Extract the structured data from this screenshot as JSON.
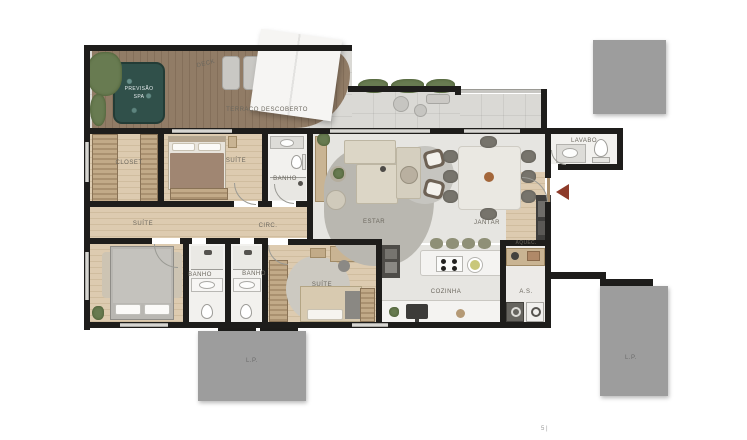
{
  "floorplan": {
    "labels": {
      "deck": "DECK",
      "terrace": "TERRAÇO DESCOBERTO",
      "spa_line1": "PREVISÃO",
      "spa_line2": "SPA",
      "closet": "CLOSET",
      "suite_master": "SUÍTE",
      "banho_master": "BANHO",
      "suite_hall": "SUÍTE",
      "circ": "CIRC.",
      "estar": "ESTAR",
      "jantar": "JANTAR",
      "lavabo": "LAVABO",
      "cozinha": "COZINHA",
      "area_servico": "A.S.",
      "aquecedor": "AQUEC.",
      "banho_2": "BANHO",
      "banho_3": "BANHO",
      "suite_3": "SUÍTE",
      "lp_bottom": "L.P.",
      "lp_right": "L.P.",
      "page_mark": "5 |"
    },
    "colors": {
      "wall": "#1e1d1b",
      "wood_floor": "#d8c6aa",
      "deck_wood": "#8b7661",
      "terrace_tile": "#dad9d5",
      "spa_water": "#30504a",
      "shaft_gray": "#9d9d9d",
      "entry_arrow": "#8e3b2a",
      "label_text": "#6b675e"
    }
  }
}
